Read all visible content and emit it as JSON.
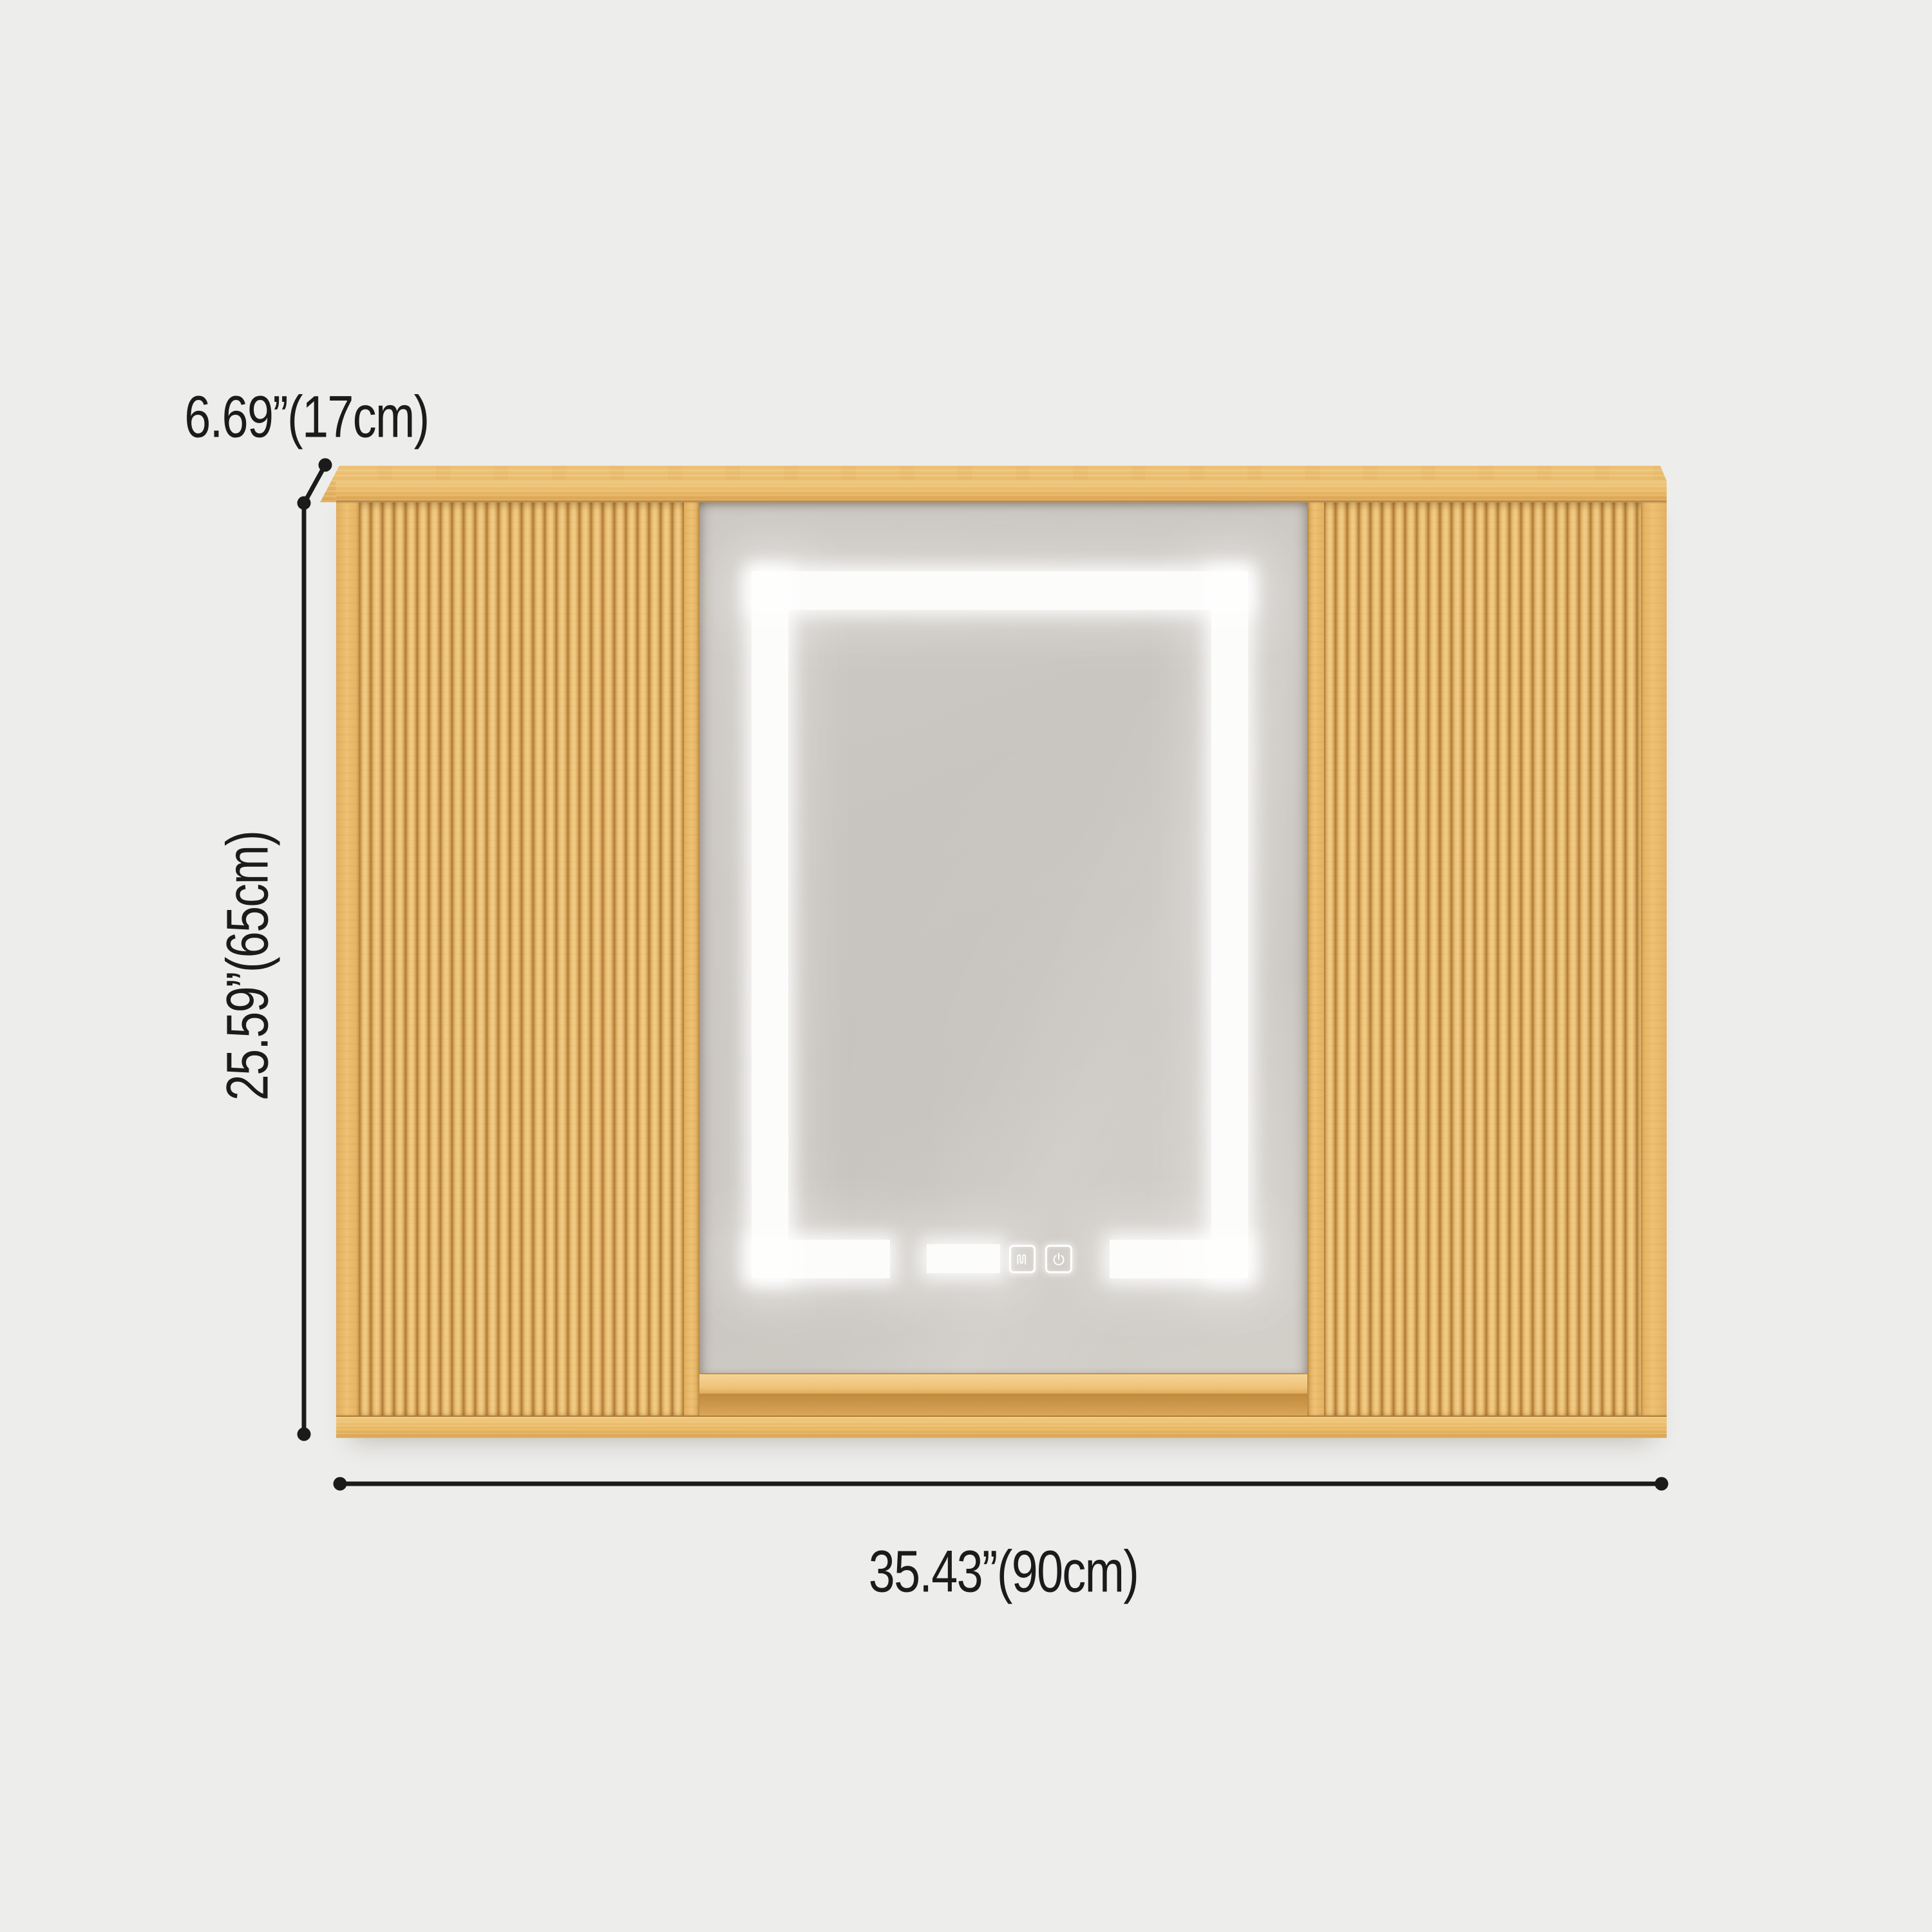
{
  "scene": {
    "type": "product-dimension-diagram",
    "subject": "fluted wood LED mirror medicine cabinet"
  },
  "annotations": {
    "depth_label": "6.69”(17cm)",
    "height_label": "25.59”(65cm)",
    "width_label": "35.43”(90cm)"
  },
  "mirror": {
    "controls": [
      {
        "icon": "defogger-icon"
      },
      {
        "icon": "power-icon"
      }
    ]
  },
  "colors": {
    "background": "#ededec",
    "dim-line": "#1b1b1b",
    "wood-light": "#f2cd88",
    "wood-base": "#e6b463",
    "wood-groove": "#aa7a3c",
    "mirror-gray": "#c7c3bf",
    "led-white": "#ffffff"
  }
}
